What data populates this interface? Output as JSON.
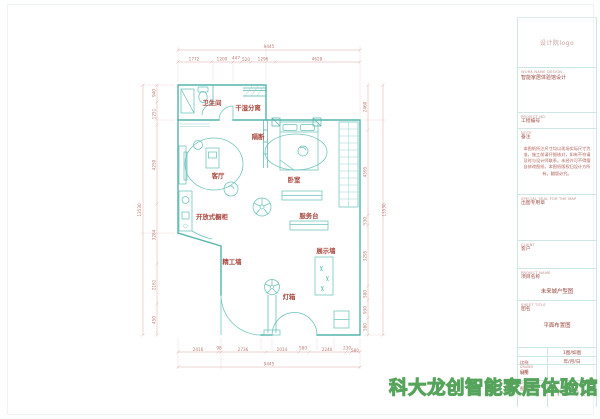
{
  "plan": {
    "rooms": {
      "bathroom": "卫生间",
      "drywet": "干湿分离",
      "partition": "隔断",
      "living": "客厅",
      "bedroom": "卧室",
      "cabinet": "开放式橱柜",
      "service": "服务台",
      "wall": "精工墙",
      "display": "展示墙",
      "lightbox": "灯箱"
    },
    "dims": {
      "top_total": "9445",
      "top": [
        "1772",
        "1200",
        "447",
        "520",
        "1296",
        "4628"
      ],
      "bottom": [
        "2416",
        "98",
        "2736",
        "2014",
        "580",
        "2240",
        "230",
        "580"
      ],
      "bottom_total": "9445",
      "left": [
        "940",
        "1251",
        "4250",
        "3284",
        "2161",
        "450"
      ],
      "left_total": "13530",
      "right": [
        "2460",
        "4595",
        "530",
        "3295",
        "580",
        "930",
        "580"
      ],
      "right_total": "13530"
    }
  },
  "titleblock": {
    "logo": "设计院logo",
    "work_header_en": "WORK NAME  DESIGN",
    "work_value": "智能家居体验馆设计",
    "project_no_en": "PROJECT NO.",
    "project_no_zh": "工程编号",
    "note_en": "NOTE",
    "note_zh": "备注",
    "note_text": "本图纸所注尺寸均以现场实际尺寸为准，施工前请仔细核对，如有不符请及时与设计师联系。未经许可不得擅自修改图纸，本图纸版权归设计方所有，翻版必究。",
    "seal_en": "SPECIAL SEAL FOR THE MAP",
    "seal_zh": "出图专用章",
    "client_en": "CLIENT",
    "client_zh": "客户",
    "project_name_en": "PROJECT NAME",
    "project_name_zh": "项目名称",
    "project_name_value": "未来城户型图",
    "sheet_title_en": "SHEET TITLE",
    "sheet_title_zh": "图名",
    "sheet_title_value": "平面布置图",
    "rows": [
      {
        "label_en": "SCALE",
        "label_zh": "比例",
        "value": "1图/如图"
      },
      {
        "label_en": "DATE",
        "label_zh": "日期",
        "value": "年/月/日"
      },
      {
        "label_en": "DRAWN",
        "label_zh": "制图",
        "value": ""
      },
      {
        "label_en": "SHEET NO.",
        "label_zh": "图号",
        "value": "PL-01"
      }
    ]
  },
  "watermark": {
    "text": "科大龙创智能家居体验馆"
  }
}
